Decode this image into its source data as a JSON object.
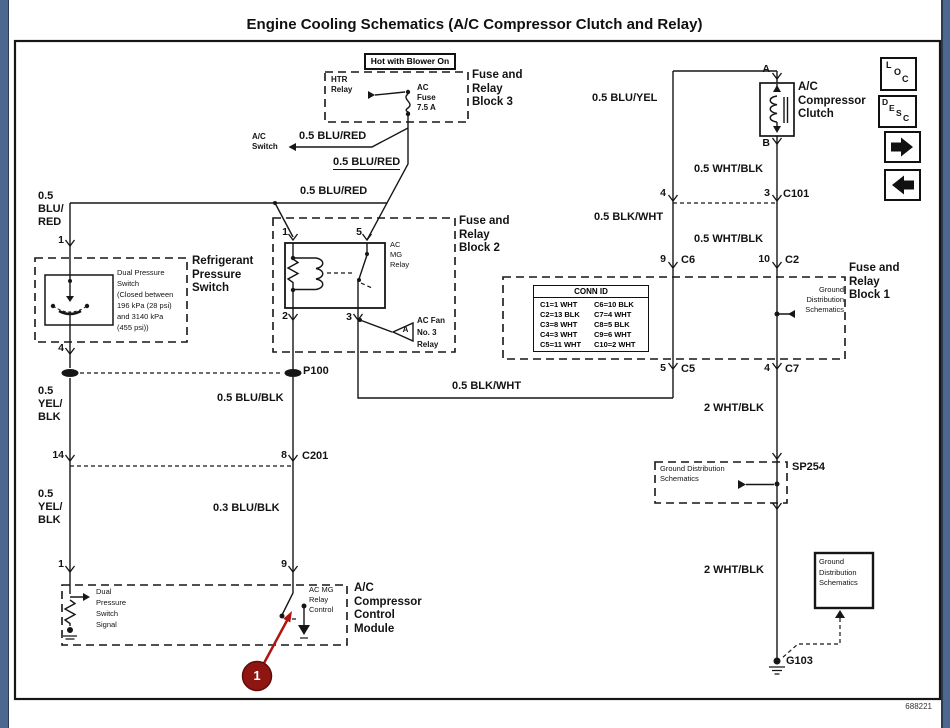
{
  "title": "Engine Cooling Schematics (A/C Compressor Clutch and Relay)",
  "figure_number": "688221",
  "frame_color": "#4d688f",
  "callout": {
    "number": "1",
    "color": "#8e1512"
  },
  "toolbar": {
    "loc": [
      "L",
      "O",
      "C"
    ],
    "desc": [
      "D",
      "E",
      "S",
      "C"
    ]
  },
  "wire_labels": {
    "blu_red": "0.5 BLU/RED",
    "blu_red_stack": [
      "0.5",
      "BLU/",
      "RED"
    ],
    "yel_blk_stack": [
      "0.5",
      "YEL/",
      "BLK"
    ],
    "blu_blk": "0.5 BLU/BLK",
    "blu_blk_03": "0.3 BLU/BLK",
    "blk_wht": "0.5 BLK/WHT",
    "blu_yel": "0.5 BLU/YEL",
    "wht_blk": "0.5 WHT/BLK",
    "wht_blk_2": "2 WHT/BLK"
  },
  "components": {
    "hot_blower": "Hot with Blower On",
    "htr_relay": [
      "HTR",
      "Relay"
    ],
    "ac_fuse": [
      "AC",
      "Fuse",
      "7.5 A"
    ],
    "block3": [
      "Fuse and",
      "Relay",
      "Block 3"
    ],
    "ac_switch": [
      "A/C",
      "Switch"
    ],
    "refrigerant": [
      "Refrigerant",
      "Pressure",
      "Switch"
    ],
    "dual_pressure": [
      "Dual  Pressure",
      "Switch",
      "(Closed between",
      "196 kPa (28 psi)",
      "and 3140 kPa",
      "(455 psi))"
    ],
    "block2": [
      "Fuse and",
      "Relay",
      "Block 2"
    ],
    "ac_mg_relay": [
      "AC",
      "MG",
      "Relay"
    ],
    "ac_fan": [
      "AC Fan",
      "No. 3",
      "Relay"
    ],
    "amp": "A",
    "block1": [
      "Fuse and",
      "Relay",
      "Block 1"
    ],
    "gds": [
      "Ground",
      "Distribution",
      "Schematics"
    ],
    "gds_wide": [
      "Ground Distribution",
      "Schematics"
    ],
    "clutch": [
      "A/C",
      "Compressor",
      "Clutch"
    ],
    "module": [
      "A/C",
      "Compressor",
      "Control",
      "Module"
    ],
    "mg_control": [
      "AC MG",
      "Relay",
      "Control"
    ],
    "dp_signal": [
      "Dual",
      "Pressure",
      "Switch",
      "Signal"
    ]
  },
  "connectors": {
    "p100": "P100",
    "c201": "C201",
    "c101": "C101",
    "c5": "C5",
    "c6": "C6",
    "c7": "C7",
    "c2": "C2",
    "sp254": "SP254",
    "g103": "G103"
  },
  "pins": {
    "n1": "1",
    "n2": "2",
    "n3": "3",
    "n4": "4",
    "n5": "5",
    "n8": "8",
    "n9": "9",
    "n10": "10",
    "n14": "14",
    "a": "A",
    "b": "B"
  },
  "conn_id": {
    "header": "CONN ID",
    "rows": [
      [
        "C1=1 WHT",
        "C6=10 BLK"
      ],
      [
        "C2=13 BLK",
        "C7=4 WHT"
      ],
      [
        "C3=8 WHT",
        "C8=5 BLK"
      ],
      [
        "C4=3 WHT",
        "C9=6 WHT"
      ],
      [
        "C5=11 WHT",
        "C10=2 WHT"
      ]
    ]
  }
}
